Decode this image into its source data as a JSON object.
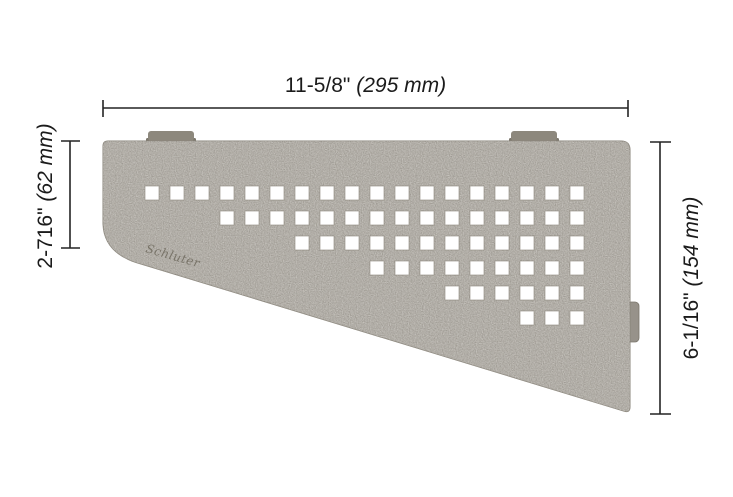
{
  "product": {
    "name": "quadrilateral-corner-shelf",
    "logo_text": "Schluter"
  },
  "dimensions": {
    "top": {
      "inches": "11-5/8\"",
      "mm": "(295 mm)"
    },
    "left": {
      "inches": "2-716\"",
      "mm": "(62 mm)"
    },
    "right": {
      "inches": "6-1/16\"",
      "mm": "(154 mm)"
    }
  },
  "colors": {
    "background": "#ffffff",
    "surface": "#a7a29a",
    "surface_edge": "#8a857b",
    "tab": "#8d887d",
    "tab_dark": "#7c776d",
    "side_tab": "#97928a",
    "line": "#242424"
  },
  "perforation_pattern": {
    "type": "square-grid-staircase",
    "origin_x": 145,
    "origin_y": 186,
    "pitch": 25,
    "hole_size": 14,
    "rows": [
      {
        "row": 0,
        "col_start": 0,
        "col_end": 17
      },
      {
        "row": 1,
        "col_start": 3,
        "col_end": 17
      },
      {
        "row": 2,
        "col_start": 6,
        "col_end": 17
      },
      {
        "row": 3,
        "col_start": 9,
        "col_end": 17
      },
      {
        "row": 4,
        "col_start": 12,
        "col_end": 17
      },
      {
        "row": 5,
        "col_start": 15,
        "col_end": 17
      }
    ]
  }
}
